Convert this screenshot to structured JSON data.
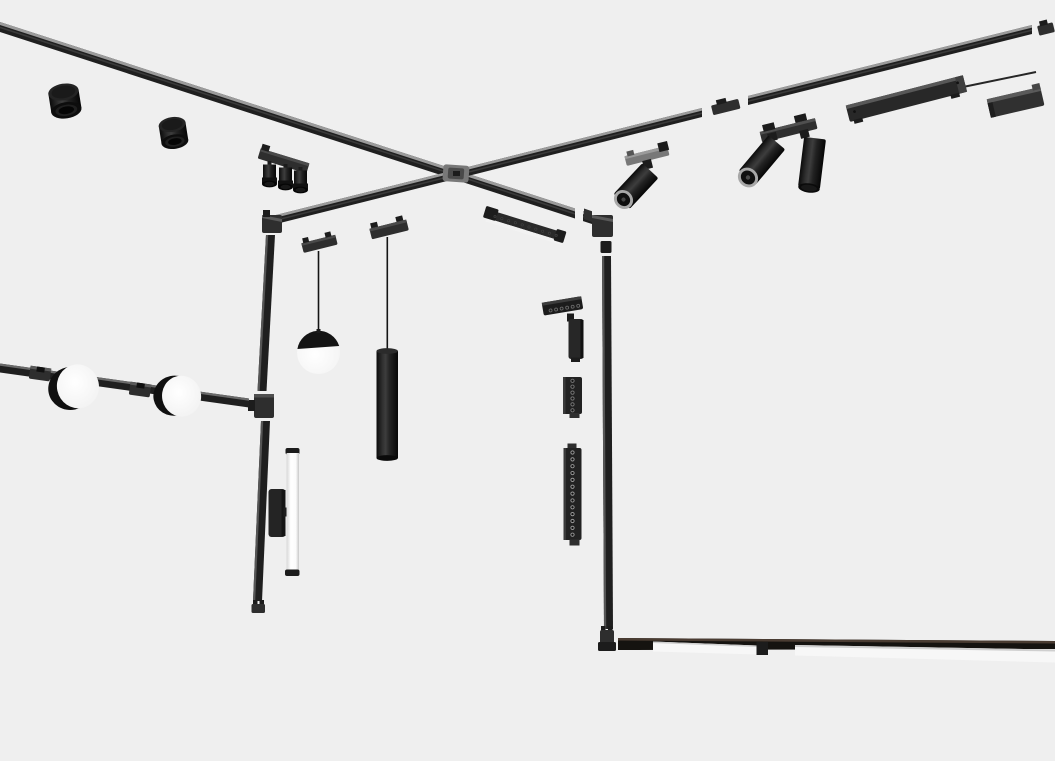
{
  "description": "Exploded 3D product render of a black magnetic track lighting system: two ceiling tracks crossing in an X, two vertical wall tracks, a horizontal wall track with round disk lights, pendant lights (sphere and tube), track spotlights, grille linear lights, a linear driver bar and a floor-level illuminated linear light, all on a plain light-gray background.",
  "colors": {
    "bg": "#efefef",
    "track-dark": "#1f1f1f",
    "track-top": "#9b9b9b",
    "track-channel": "#3a3a3a",
    "fixture-black": "#1c1c1c",
    "fixture-mid": "#2e2e2e",
    "metal": "#787878",
    "lens-ring": "#a8a8a8",
    "diffuser": "#f7f7f7",
    "cord": "#141414",
    "floor-tint": "#4a3c32",
    "white-face": "#ffffff"
  },
  "scene": {
    "dot_counts": {
      "wall_washer": 6,
      "grille_short": 6,
      "grille_long": 13,
      "ceiling_linear": 10,
      "triple_spot_heads": 3
    },
    "items": [
      {
        "name": "ceiling-track-front",
        "type": "track",
        "bbox": [
          0,
          22,
          592,
          202
        ]
      },
      {
        "name": "ceiling-track-right",
        "type": "track",
        "bbox": [
          262,
          21,
          793,
          209
        ]
      },
      {
        "name": "cross-connector",
        "type": "connector",
        "bbox": [
          443,
          164,
          27,
          19
        ]
      },
      {
        "name": "surface-cylinder-downlight-large",
        "type": "downlight",
        "bbox": [
          48,
          81,
          34,
          37
        ]
      },
      {
        "name": "surface-cylinder-downlight-small",
        "type": "downlight",
        "bbox": [
          160,
          120,
          27,
          30
        ]
      },
      {
        "name": "triple-spot-bar",
        "type": "spotlight",
        "bbox": [
          257,
          149,
          53,
          40
        ]
      },
      {
        "name": "single-track-spotlight",
        "type": "spotlight",
        "bbox": [
          612,
          143,
          60,
          65
        ]
      },
      {
        "name": "double-track-spotlight",
        "type": "spotlight",
        "bbox": [
          740,
          115,
          82,
          78
        ]
      },
      {
        "name": "linear-driver-bar",
        "type": "driver",
        "bbox": [
          845,
          80,
          122,
          38
        ]
      },
      {
        "name": "mounting-box",
        "type": "accessory",
        "bbox": [
          985,
          88,
          58,
          28
        ]
      },
      {
        "name": "left-wall-track",
        "type": "track",
        "bbox": [
          248,
          210,
          36,
          404
        ]
      },
      {
        "name": "right-wall-track",
        "type": "track",
        "bbox": [
          592,
          214,
          26,
          438
        ]
      },
      {
        "name": "ceiling-linear-grille-light",
        "type": "linear-light",
        "bbox": [
          484,
          207,
          82,
          38
        ]
      },
      {
        "name": "sphere-pendant",
        "type": "pendant",
        "bbox": [
          297,
          234,
          45,
          140
        ]
      },
      {
        "name": "tube-pendant",
        "type": "pendant",
        "bbox": [
          370,
          219,
          38,
          242
        ]
      },
      {
        "name": "folded-wall-washer",
        "type": "wall-light",
        "bbox": [
          542,
          296,
          42,
          64
        ]
      },
      {
        "name": "short-grille-spot",
        "type": "linear-light",
        "bbox": [
          563,
          377,
          19,
          41
        ]
      },
      {
        "name": "long-grille-spot",
        "type": "linear-light",
        "bbox": [
          563,
          443,
          19,
          103
        ]
      },
      {
        "name": "wall-horizontal-track",
        "type": "track",
        "bbox": [
          0,
          363,
          250,
          45
        ]
      },
      {
        "name": "round-disk-light-1",
        "type": "disk-light",
        "bbox": [
          48,
          364,
          51,
          45
        ]
      },
      {
        "name": "round-disk-light-2",
        "type": "disk-light",
        "bbox": [
          154,
          373,
          50,
          45
        ]
      },
      {
        "name": "wall-tube-light",
        "type": "tube-light",
        "bbox": [
          285,
          448,
          15,
          128
        ]
      },
      {
        "name": "wall-tube-bracket",
        "type": "bracket",
        "bbox": [
          268,
          489,
          23,
          48
        ]
      },
      {
        "name": "floor-track-linear-light",
        "type": "linear-light",
        "bbox": [
          598,
          630,
          457,
          33
        ]
      }
    ]
  }
}
